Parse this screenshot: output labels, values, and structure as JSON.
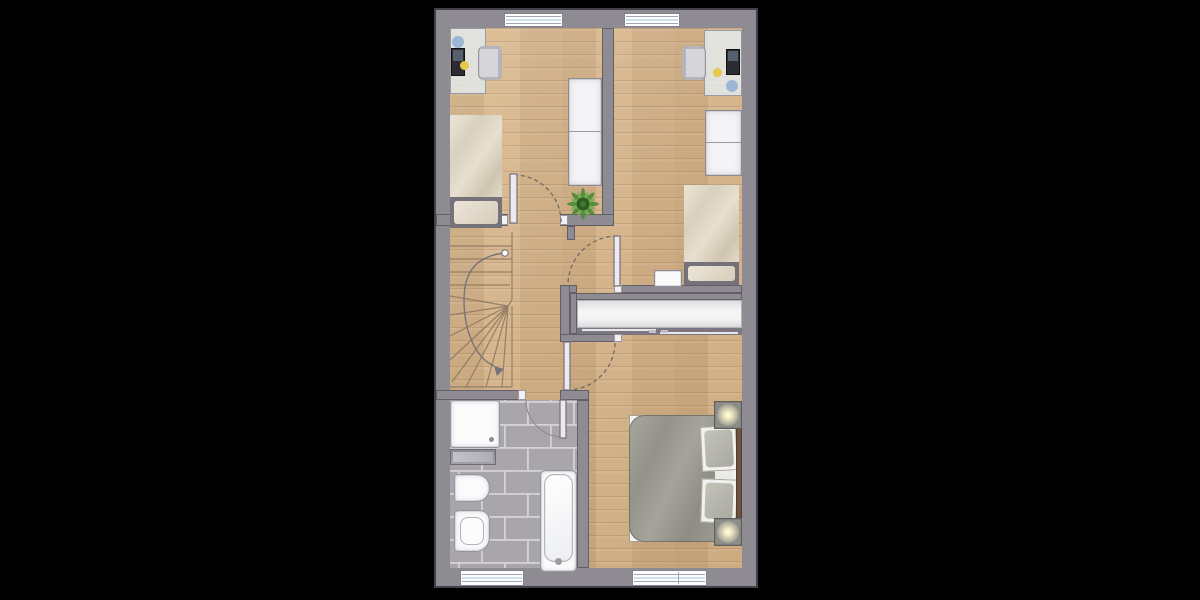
{
  "scene": {
    "kind": "architectural-floor-plan",
    "storey": "upper floor",
    "background": "#000000",
    "plan_outline_px": {
      "left": 434,
      "top": 8,
      "width": 324,
      "height": 580
    },
    "text_labels": []
  },
  "palette": {
    "bg": "#000000",
    "wall": "#8f8b92",
    "wall_edge": "#4a474e",
    "floor_wood": "#d2b189",
    "tile_grey": "#a8a6aa",
    "tile_grout": "#d6d4d6",
    "fixture_white": "#fbfbfc",
    "duvet_beige": "#ddd5c4",
    "duvet_grey_green": "#9a9a91",
    "headboard_brown": "#6b5343",
    "plant_green": "#4e8b3a",
    "walkline_grey": "#77737b",
    "door_arc": "#6f6a62",
    "lamp_glow": "#fffce6"
  },
  "windows": [
    {
      "id": "top-left-window",
      "wall": "north",
      "room": "bedroom-left"
    },
    {
      "id": "top-right-window",
      "wall": "north",
      "room": "bedroom-right"
    },
    {
      "id": "bottom-left-window",
      "wall": "south",
      "room": "bathroom"
    },
    {
      "id": "bottom-right-window",
      "wall": "south",
      "room": "master-bedroom"
    }
  ],
  "doors": [
    {
      "id": "door-bedroom-left",
      "type": "hinged",
      "swing": "into landing corner",
      "style": "dashed-arc"
    },
    {
      "id": "door-bedroom-right",
      "type": "hinged",
      "swing": "into bedroom",
      "style": "dashed-arc"
    },
    {
      "id": "door-master-bedroom",
      "type": "hinged",
      "swing": "into master bedroom",
      "style": "dashed-arc"
    },
    {
      "id": "door-bathroom",
      "type": "hinged",
      "swing": "into bathroom",
      "style": "thin-arc"
    }
  ],
  "rooms": [
    {
      "name": "bedroom-left",
      "floor": "wood",
      "furniture": [
        "desk with laptop and desk items",
        "desk chair",
        "single bed",
        "two-section wardrobe",
        "potted plant"
      ]
    },
    {
      "name": "bedroom-right",
      "floor": "wood",
      "furniture": [
        "desk with laptop and desk items",
        "desk chair",
        "single bed",
        "two-section wardrobe",
        "nightstand"
      ]
    },
    {
      "name": "landing",
      "floor": "wood",
      "furniture": [
        "winder staircase with walk line arrow"
      ]
    },
    {
      "name": "bathroom",
      "floor": "grey brick tiles",
      "furniture": [
        "shower tray",
        "radiator shelf",
        "wash basin",
        "toilet",
        "bathtub with faucet"
      ]
    },
    {
      "name": "master-bedroom",
      "floor": "wood",
      "furniture": [
        "double bed with grey duvet and two pillows",
        "headboard",
        "nightstand with lamp (top)",
        "nightstand with lamp (bottom)",
        "built-in sliding-door closet"
      ]
    }
  ],
  "stairs": {
    "type": "winder-U",
    "treads": 13,
    "walk_line": "circle start top, arrow end bottom"
  }
}
